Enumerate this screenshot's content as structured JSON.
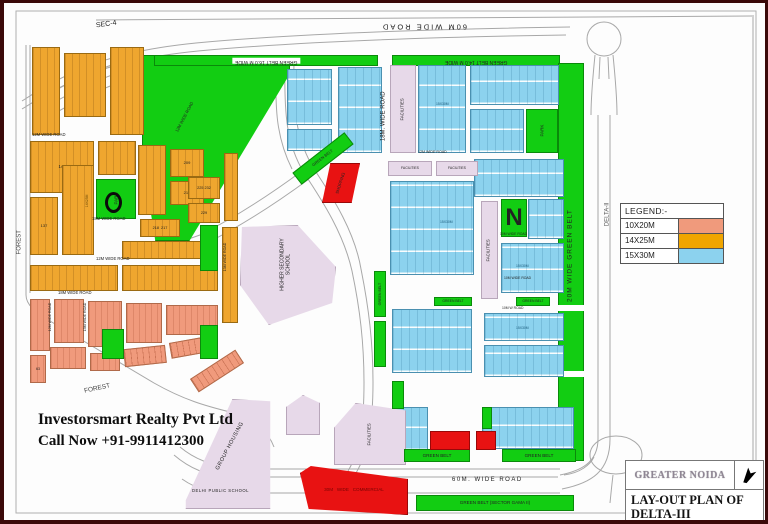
{
  "branding": {
    "line1": "Investorsmart Realty Pvt Ltd",
    "line2": "Call Now +91-9911412300"
  },
  "legend": {
    "title": "LEGEND:-",
    "items": [
      {
        "label": "10X20M",
        "color": "#f09a7c"
      },
      {
        "label": "14X25M",
        "color": "#f0a500"
      },
      {
        "label": "15X30M",
        "color": "#8cd2ee"
      }
    ]
  },
  "title_block": {
    "agency": "GREATER NOIDA",
    "plan_title": "LAY-OUT PLAN OF DELTA-III",
    "north_icon": "north-arrow-icon"
  },
  "colors": {
    "green_belt": "#12cd12",
    "plots_10x20": "#f09a7c",
    "plots_14x25": "#efa62f",
    "plots_15x30": "#8cd2ee",
    "facilities": "#e7d9e9",
    "commercial": "#e81212",
    "border": "#3b0909"
  },
  "map": {
    "blocks": [
      {
        "t": "g",
        "x": 138,
        "y": 52,
        "w": 148,
        "h": 186,
        "clip": "0% 0%,100% 0%,100% 10%,32% 100%,9% 100%,0% 55%",
        "n": "green-belt-diagonal"
      },
      {
        "t": "g",
        "x": 150,
        "y": 52,
        "w": 224,
        "h": 11,
        "l": "GREEN BELT 16.0 M WIDE",
        "lr": 180,
        "ls": 5,
        "lbg": "#fff",
        "n": "green-belt-top-west"
      },
      {
        "t": "g",
        "x": 388,
        "y": 52,
        "w": 168,
        "h": 11,
        "l": "GREEN BELT 14.0 M WIDE",
        "lr": 180,
        "ls": 5,
        "n": "green-belt-top-east"
      },
      {
        "t": "g",
        "x": 554,
        "y": 60,
        "w": 26,
        "h": 398,
        "n": "green-belt-right"
      },
      {
        "t": "white",
        "x": 554,
        "y": 302,
        "w": 26,
        "h": 6
      },
      {
        "t": "white",
        "x": 554,
        "y": 368,
        "w": 26,
        "h": 6
      },
      {
        "t": "o",
        "x": 28,
        "y": 44,
        "w": 28,
        "h": 88
      },
      {
        "t": "o",
        "x": 60,
        "y": 50,
        "w": 42,
        "h": 64
      },
      {
        "t": "o",
        "x": 106,
        "y": 44,
        "w": 34,
        "h": 88
      },
      {
        "t": "o",
        "x": 220,
        "y": 150,
        "w": 14,
        "h": 68
      },
      {
        "t": "o",
        "x": 26,
        "y": 138,
        "w": 64,
        "h": 52,
        "l": "144",
        "ls": 4.2
      },
      {
        "t": "o",
        "x": 94,
        "y": 138,
        "w": 38,
        "h": 34
      },
      {
        "t": "o",
        "x": 134,
        "y": 142,
        "w": 28,
        "h": 70
      },
      {
        "t": "o",
        "x": 166,
        "y": 146,
        "w": 34,
        "h": 28,
        "l": "209",
        "ls": 4
      },
      {
        "t": "o",
        "x": 166,
        "y": 178,
        "w": 34,
        "h": 24,
        "l": "213",
        "ls": 4
      },
      {
        "t": "o",
        "x": 26,
        "y": 194,
        "w": 28,
        "h": 58,
        "l": "137",
        "ls": 4
      },
      {
        "t": "o",
        "x": 58,
        "y": 162,
        "w": 32,
        "h": 90
      },
      {
        "t": "o",
        "x": 136,
        "y": 216,
        "w": 40,
        "h": 18,
        "l": "218  217",
        "ls": 3.8
      },
      {
        "t": "o",
        "x": 184,
        "y": 174,
        "w": 32,
        "h": 22,
        "l": "225 232",
        "ls": 3.8
      },
      {
        "t": "o",
        "x": 184,
        "y": 200,
        "w": 32,
        "h": 20,
        "l": "229",
        "ls": 3.8
      },
      {
        "t": "o",
        "x": 118,
        "y": 238,
        "w": 96,
        "h": 18
      },
      {
        "t": "o",
        "x": 26,
        "y": 262,
        "w": 88,
        "h": 26
      },
      {
        "t": "o",
        "x": 118,
        "y": 262,
        "w": 96,
        "h": 26
      },
      {
        "t": "o",
        "x": 218,
        "y": 224,
        "w": 16,
        "h": 96
      },
      {
        "t": "s",
        "x": 26,
        "y": 296,
        "w": 20,
        "h": 52
      },
      {
        "t": "s",
        "x": 50,
        "y": 296,
        "w": 30,
        "h": 44
      },
      {
        "t": "s",
        "x": 84,
        "y": 298,
        "w": 34,
        "h": 46
      },
      {
        "t": "s",
        "x": 122,
        "y": 300,
        "w": 36,
        "h": 40
      },
      {
        "t": "s",
        "x": 162,
        "y": 302,
        "w": 52,
        "h": 30
      },
      {
        "t": "s",
        "x": 26,
        "y": 352,
        "w": 16,
        "h": 28,
        "l": "63",
        "ls": 3.6
      },
      {
        "t": "s",
        "x": 46,
        "y": 344,
        "w": 36,
        "h": 22
      },
      {
        "t": "s",
        "x": 86,
        "y": 350,
        "w": 30,
        "h": 18
      },
      {
        "t": "s",
        "x": 120,
        "y": 344,
        "w": 42,
        "h": 18,
        "rot": -6
      },
      {
        "t": "s",
        "x": 166,
        "y": 336,
        "w": 44,
        "h": 16,
        "rot": -10
      },
      {
        "t": "s",
        "x": 186,
        "y": 360,
        "w": 54,
        "h": 16,
        "rot": -33
      },
      {
        "t": "b",
        "x": 283,
        "y": 66,
        "w": 45,
        "h": 56
      },
      {
        "t": "b",
        "x": 283,
        "y": 126,
        "w": 45,
        "h": 22
      },
      {
        "t": "b",
        "x": 334,
        "y": 64,
        "w": 44,
        "h": 86
      },
      {
        "t": "b",
        "x": 414,
        "y": 62,
        "w": 48,
        "h": 88
      },
      {
        "t": "b",
        "x": 466,
        "y": 62,
        "w": 89,
        "h": 40
      },
      {
        "t": "b",
        "x": 466,
        "y": 106,
        "w": 54,
        "h": 44
      },
      {
        "t": "b",
        "x": 470,
        "y": 156,
        "w": 90,
        "h": 38
      },
      {
        "t": "b",
        "x": 386,
        "y": 178,
        "w": 84,
        "h": 94
      },
      {
        "t": "b",
        "x": 524,
        "y": 196,
        "w": 36,
        "h": 40
      },
      {
        "t": "b",
        "x": 497,
        "y": 240,
        "w": 63,
        "h": 50
      },
      {
        "t": "b",
        "x": 388,
        "y": 306,
        "w": 80,
        "h": 64
      },
      {
        "t": "b",
        "x": 480,
        "y": 310,
        "w": 80,
        "h": 28
      },
      {
        "t": "b",
        "x": 480,
        "y": 342,
        "w": 80,
        "h": 32
      },
      {
        "t": "b",
        "x": 390,
        "y": 404,
        "w": 34,
        "h": 44
      },
      {
        "t": "b",
        "x": 478,
        "y": 404,
        "w": 92,
        "h": 42
      },
      {
        "t": "f",
        "x": 386,
        "y": 62,
        "w": 26,
        "h": 88,
        "l": "FACILITIES",
        "lr": -90,
        "ls": 4.2,
        "n": "facilities-strip"
      },
      {
        "t": "f",
        "x": 477,
        "y": 198,
        "w": 17,
        "h": 98,
        "l": "FACILITIES",
        "lr": -90,
        "ls": 4.2,
        "n": "facilities-strip"
      },
      {
        "t": "f",
        "x": 384,
        "y": 158,
        "w": 44,
        "h": 15,
        "l": "FACILITIES",
        "ls": 3.4,
        "n": "facilities-bar"
      },
      {
        "t": "f",
        "x": 432,
        "y": 158,
        "w": 42,
        "h": 15,
        "l": "FACILITIES",
        "ls": 3.4,
        "n": "facilities-bar"
      },
      {
        "t": "f",
        "x": 236,
        "y": 222,
        "w": 96,
        "h": 100,
        "clip": "2% 2%,60% 0%,100% 42%,96% 78%,30% 100%,0% 60%",
        "n": "higher-secondary-school"
      },
      {
        "t": "f",
        "x": 180,
        "y": 396,
        "w": 88,
        "h": 110,
        "clip": "55% 0%,98% 2%,98% 100%,2% 100%,2% 92%",
        "n": "group-housing"
      },
      {
        "t": "f",
        "x": 330,
        "y": 400,
        "w": 72,
        "h": 62,
        "clip": "30% 0%,100% 12%,100% 100%,0% 100%,0% 40%",
        "l": "FACILITIES",
        "lr": -90,
        "ls": 4.2,
        "n": "facilities-area"
      },
      {
        "t": "f",
        "x": 282,
        "y": 392,
        "w": 34,
        "h": 40,
        "clip": "50% 0%,100% 20%,100% 100%,0% 100%,0% 30%"
      },
      {
        "t": "g",
        "x": 92,
        "y": 176,
        "w": 40,
        "h": 40,
        "l": "PARK",
        "lr": -90,
        "ls": 4.5,
        "n": "park"
      },
      {
        "t": "g",
        "x": 196,
        "y": 222,
        "w": 18,
        "h": 46,
        "n": "park"
      },
      {
        "t": "g",
        "x": 196,
        "y": 322,
        "w": 18,
        "h": 34,
        "n": "park"
      },
      {
        "t": "g",
        "x": 98,
        "y": 326,
        "w": 22,
        "h": 30,
        "n": "park"
      },
      {
        "t": "g",
        "x": 522,
        "y": 106,
        "w": 32,
        "h": 44,
        "l": "PARK",
        "lr": -90,
        "ls": 4.5,
        "n": "park"
      },
      {
        "t": "g",
        "x": 497,
        "y": 196,
        "w": 26,
        "h": 38,
        "l": "N",
        "ls": 24,
        "lb": 1,
        "n": "park-n"
      },
      {
        "t": "g",
        "x": 370,
        "y": 268,
        "w": 12,
        "h": 46,
        "l": "GREEN BELT",
        "lr": -90,
        "ls": 3.6,
        "n": "green-belt-strip"
      },
      {
        "t": "g",
        "x": 370,
        "y": 318,
        "w": 12,
        "h": 46,
        "n": "green-belt-strip"
      },
      {
        "t": "g",
        "x": 286,
        "y": 148,
        "w": 66,
        "h": 15,
        "rot": -38,
        "l": "GREEN BELT",
        "ls": 4,
        "n": "green-belt-strip"
      },
      {
        "t": "g",
        "x": 430,
        "y": 294,
        "w": 38,
        "h": 9,
        "l": "GREEN BELT",
        "ls": 3.4
      },
      {
        "t": "g",
        "x": 512,
        "y": 294,
        "w": 34,
        "h": 9,
        "l": "GREEN BELT",
        "ls": 3.4
      },
      {
        "t": "g",
        "x": 388,
        "y": 378,
        "w": 12,
        "h": 28
      },
      {
        "t": "g",
        "x": 478,
        "y": 404,
        "w": 10,
        "h": 22
      },
      {
        "t": "g",
        "x": 400,
        "y": 446,
        "w": 66,
        "h": 13,
        "l": "GREEN BELT",
        "ls": 4.6
      },
      {
        "t": "g",
        "x": 498,
        "y": 446,
        "w": 74,
        "h": 13,
        "l": "GREEN BELT",
        "ls": 4.6
      },
      {
        "t": "g",
        "x": 412,
        "y": 492,
        "w": 158,
        "h": 16,
        "l": "GREEN BELT (SECTOR GAMA II)",
        "ls": 4.6,
        "n": "green-belt-gama"
      },
      {
        "t": "r",
        "x": 318,
        "y": 160,
        "w": 38,
        "h": 40,
        "clip": "22% 0%,100% 0%,78% 100%,0% 100%",
        "l": "SHOPPING",
        "lr": -72,
        "ls": 4.2,
        "n": "shopping-block"
      },
      {
        "t": "r",
        "x": 426,
        "y": 428,
        "w": 40,
        "h": 19,
        "n": "shopping-block"
      },
      {
        "t": "r",
        "x": 472,
        "y": 428,
        "w": 20,
        "h": 19,
        "n": "shopping-block"
      },
      {
        "t": "r",
        "x": 296,
        "y": 462,
        "w": 108,
        "h": 50,
        "clip": "0% 16%,10% 2%,100% 28%,100% 100%,8% 88%",
        "l": "30M   WIDE   COMMERCIAL",
        "ls": 4.6,
        "lc": "#7a0303",
        "n": "commercial-belt"
      },
      {
        "t": "ring",
        "x": 101,
        "y": 189,
        "w": 17,
        "h": 21,
        "n": "highlight-ring"
      }
    ],
    "labels": [
      {
        "x": 92,
        "y": 18,
        "t": "SEC-4",
        "r": -8,
        "s": 7
      },
      {
        "x": 330,
        "y": 19,
        "t": "60M      WIDE      ROAD",
        "r": 180,
        "s": 7.5,
        "sp": 2,
        "w": 180
      },
      {
        "x": 330,
        "y": 110,
        "t": "18M.  WIDE  ROAD",
        "r": -90,
        "s": 6,
        "w": 100
      },
      {
        "x": 28,
        "y": 130,
        "t": "12M WIDE ROAD",
        "s": 4.2
      },
      {
        "x": 88,
        "y": 214,
        "t": "18M WIDE ROAD",
        "s": 4.2
      },
      {
        "x": 92,
        "y": 254,
        "t": "12M WIDE ROAD",
        "s": 4.2
      },
      {
        "x": 54,
        "y": 288,
        "t": "18M WIDE ROAD",
        "s": 4.2
      },
      {
        "x": -14,
        "y": 236,
        "t": "FOREST",
        "r": -90,
        "s": 6,
        "w": 60,
        "c": "#444"
      },
      {
        "x": 80,
        "y": 382,
        "t": "FOREST",
        "r": -12,
        "s": 6.5,
        "c": "#444"
      },
      {
        "x": 146,
        "y": 112,
        "t": "12M WIDE ROAD",
        "r": -62,
        "s": 4.2,
        "w": 70
      },
      {
        "x": 576,
        "y": 208,
        "t": "DELTA-II",
        "r": -90,
        "s": 6,
        "w": 56,
        "c": "#555"
      },
      {
        "x": 481,
        "y": 249,
        "t": "20M   WIDE   GREEN   BELT",
        "r": -90,
        "s": 6.5,
        "w": 170,
        "sp": 1
      },
      {
        "x": 448,
        "y": 474,
        "t": "60M.    WIDE    ROAD",
        "s": 6,
        "sp": 1.5
      },
      {
        "x": 188,
        "y": 486,
        "t": "DELHI PUBLIC SCHOOL",
        "s": 4.2,
        "sp": 0.5
      },
      {
        "x": 250,
        "y": 256,
        "t": "HIGHER SECONDARY SCHOOL",
        "r": -90,
        "s": 5,
        "w": 64
      },
      {
        "x": 196,
        "y": 440,
        "t": "GROUP HOUSING",
        "r": -62,
        "s": 5.5,
        "w": 60,
        "sp": 0.5
      },
      {
        "x": 414,
        "y": 148,
        "t": "12M WIDE ROAD",
        "s": 3.6
      },
      {
        "x": 496,
        "y": 230,
        "t": "10M WIDE ROAD",
        "s": 3.4
      },
      {
        "x": 500,
        "y": 274,
        "t": "10M WIDE ROAD",
        "s": 3.4
      },
      {
        "x": 498,
        "y": 304,
        "t": "10M  W  ROAD",
        "s": 3.4
      },
      {
        "x": 25,
        "y": 312,
        "t": "12M WIDE ROAD",
        "r": -90,
        "s": 3.6,
        "w": 44
      },
      {
        "x": 60,
        "y": 312,
        "t": "15M WIDE ROAD",
        "r": -90,
        "s": 3.6,
        "w": 44
      },
      {
        "x": 200,
        "y": 252,
        "t": "13M WIDE ROAD",
        "r": -90,
        "s": 3.6,
        "w": 44
      },
      {
        "x": 432,
        "y": 100,
        "t": "15X30M",
        "s": 3.4,
        "c": "#1a5a7a"
      },
      {
        "x": 436,
        "y": 218,
        "t": "15X30M",
        "s": 3.4,
        "c": "#1a5a7a"
      },
      {
        "x": 512,
        "y": 262,
        "t": "15X30M",
        "s": 3.4,
        "c": "#1a5a7a"
      },
      {
        "x": 512,
        "y": 324,
        "t": "15X30M",
        "s": 3.4,
        "c": "#1a5a7a"
      },
      {
        "x": 64,
        "y": 196,
        "t": "14X25M",
        "r": -90,
        "s": 3.4,
        "w": 40,
        "c": "#6b4a08"
      }
    ]
  }
}
